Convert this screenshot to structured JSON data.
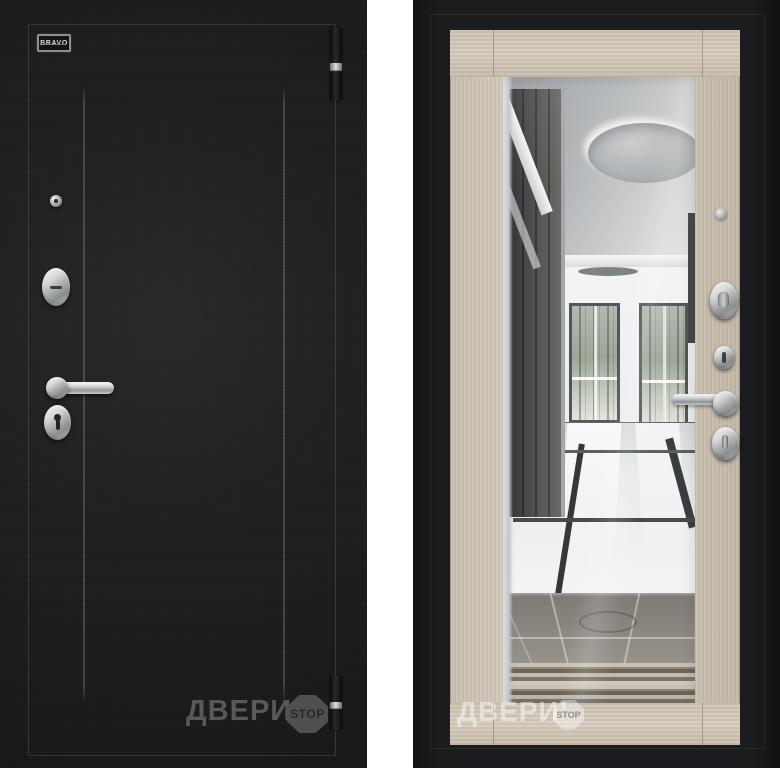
{
  "left_door": {
    "badge_label": "BRAVO",
    "watermark": {
      "text": "ДВЕРИ’",
      "badge": "STOP"
    }
  },
  "right_door": {
    "watermark": {
      "text": "ДВЕРИ’",
      "badge": "STOP"
    }
  },
  "colors": {
    "door_black": "#1c1e20",
    "frame_black": "#17181a",
    "wood_cappuccino": "#cfc6b8",
    "chrome": "#c9ccce",
    "watermark_gray": "#59595b",
    "background_white": "#ffffff"
  }
}
